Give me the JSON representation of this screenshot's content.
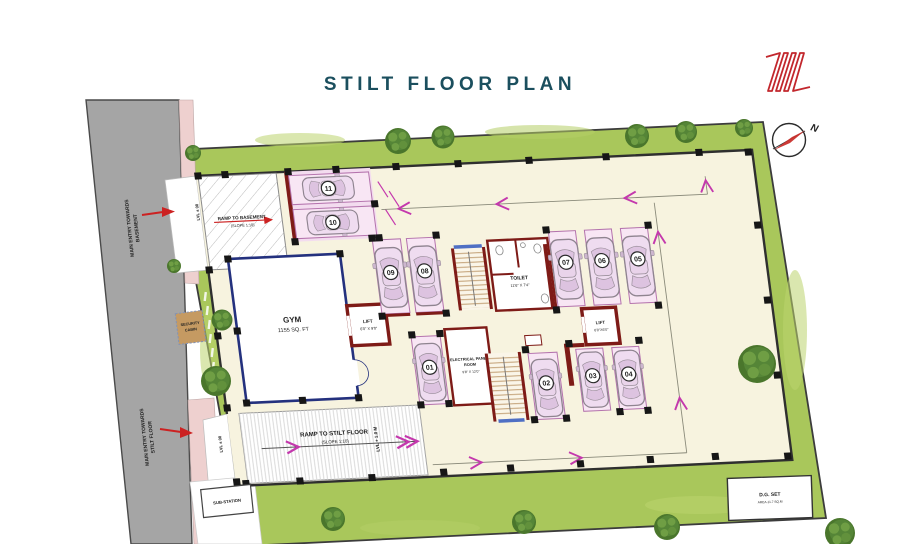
{
  "title": "STILT FLOOR PLAN",
  "compass": {
    "north": "N"
  },
  "road": {
    "entry_basement_line1": "MAIN ENTRY TOWARDS",
    "entry_basement_line2": "BASEMENT",
    "entry_stilt_line1": "MAIN ENTRY TOWARDS",
    "entry_stilt_line2": "STILT FLOOR"
  },
  "levels": {
    "entry_basement": "LVL ± 00",
    "entry_stilt": "LVL ± 00",
    "stilt_floor": "LVL + 1.0 M"
  },
  "ramps": {
    "basement": {
      "label": "RAMP TO BASEMENT",
      "slope": "(SLOPE 1:10)"
    },
    "stilt": {
      "label": "RAMP TO STILT FLOOR",
      "slope": "(SLOPE 1:10)"
    }
  },
  "rooms": {
    "gym": {
      "name": "GYM",
      "area": "1155 SQ. FT"
    },
    "lift_upper": {
      "name": "LIFT",
      "size": "6'0\" X 9'0\""
    },
    "lift_lower": {
      "name": "LIFT",
      "size": "6'0\"X6'0\""
    },
    "toilet": {
      "name": "TOILET",
      "size": "11'6\" X 7'4\""
    },
    "electrical_panel_room": {
      "name_line1": "ELECTRICAL PANEL",
      "name_line2": "ROOM",
      "size": "9'8\" X 12'0\""
    },
    "security_cabin": {
      "line1": "SECURITY",
      "line2": "CABIN"
    },
    "substation": {
      "name": "SUB-STATION"
    },
    "dg_set": {
      "name": "D.G. SET",
      "note": "AREA-11.7 SQ.M"
    }
  },
  "parking": {
    "stalls": [
      "11",
      "10",
      "09",
      "08",
      "07",
      "06",
      "05",
      "01",
      "02",
      "03",
      "04"
    ]
  },
  "colors": {
    "title_teal": "#1b4f5e",
    "accent_red": "#c2272d",
    "wall_maroon": "#7e1b17",
    "wall_navy": "#24317e",
    "lawn_green": "#a9c75b",
    "stall_pink": "#f6e0f1",
    "floor_cream": "#f7f3df",
    "arrow_magenta": "#c438ad"
  }
}
